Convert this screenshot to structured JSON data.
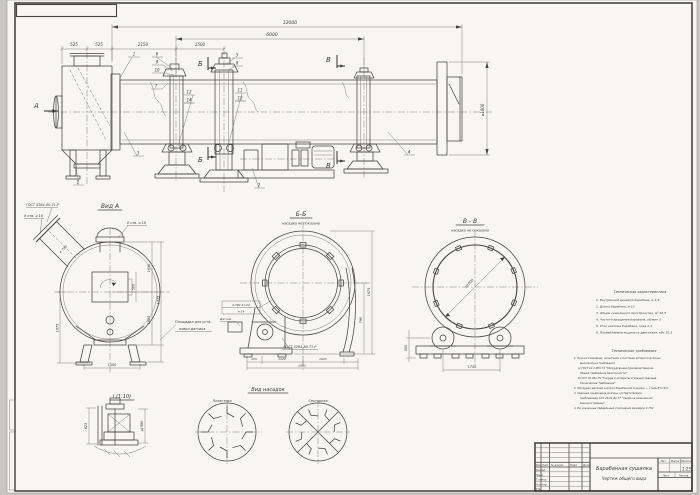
{
  "colors": {
    "paper": "#f7f6f1",
    "background": "#c7c6c1",
    "line": "#45443e",
    "thin_line": "#74736b",
    "text": "#3e3d37"
  },
  "main_view": {
    "view_arrow_label": "А",
    "section_b_label": "Б",
    "section_v_label": "В",
    "dims": {
      "overall": "12000",
      "between_supports": "6000",
      "left_a": "525",
      "left_b": "525",
      "left_c": "2150",
      "left_d": "1500",
      "drum_dia": "⌀1800"
    },
    "callouts": [
      "1",
      "2",
      "3",
      "4",
      "5",
      "6",
      "7",
      "8",
      "9",
      "10",
      "11",
      "12",
      "13",
      "14"
    ]
  },
  "view_a": {
    "title": "Вид А",
    "weld_note": "ГОСТ 5264-80-Т1-Р",
    "holes_left": "8 отв. ⌀ 18",
    "holes_top": "8 отв. ⌀ 18",
    "nozzle_dia": "⌀ 790",
    "hatch_dim": "500",
    "dim_right_top": "1630",
    "dim_right_bottom": "1605",
    "dim_right_overall": "1775",
    "dim_left": "1675",
    "dim_bottom": "1500",
    "platform_note_line1": "Площадка для уста-",
    "platform_note_line2": "новки датчика"
  },
  "section_bb": {
    "title": "Б-Б",
    "subtitle": "насадка не показана",
    "weld_flag_top": "2-Т82 Σ=22",
    "weld_flag_bottom": "п-14",
    "sensor_label": "Датчик",
    "weld_note": "ГОСТ 5264-80-Т1-Р",
    "dim_right_overall": "1675",
    "dim_right_inner": "790",
    "dim_bottom_a": "105",
    "dim_bottom_b": "1220",
    "dim_bottom_c": "1625",
    "dim_bottom_overall": "1683"
  },
  "section_vv": {
    "title": "В - В",
    "subtitle": "насадка не показана",
    "drum_dia": "⌀1800",
    "dim_bottom": "1750",
    "dim_left": "500"
  },
  "nozzle_views": {
    "title": "Вид насадок",
    "left_label": "Лопастная",
    "right_label": "Секторная"
  },
  "detail_i": {
    "title": "I (1:10)",
    "dim_right": "⌀1580",
    "dim_left": "625"
  },
  "tech_char": {
    "title": "Техническая характеристика",
    "items": [
      "1. Внутренний диаметр барабана, м 1,8",
      "2. Длина барабана, м 12",
      "3. Объем сушильного пространства, м³ 30,5",
      "4. Частота вращения барабана, об/мин 5",
      "5. Угол наклона барабана, град 2,4",
      "6. Потребляемая мощность двигателя, кВт 10,3"
    ]
  },
  "tech_req": {
    "title": "Технические требования",
    "lines": [
      "1. При изготовлении, испытании и поставке аппарата должны",
      "выполняться требования:",
      "а) ГОСТ 12.2.003-74 \"Оборудование производственное.",
      "Общие требования безопасности\";",
      "б) ОСТ 26.291-79 \"Сосуды и аппараты стальные сварные.",
      "Технические требования\".",
      "2. Материал деталей корпуса барабанной сушилки — сталь В Ст3сп.",
      "3. Сварные соединения должны соответствовать",
      "требованиям ОСТ 26-01-82-77 \"Сварка в химическом",
      "машиностроении\".",
      "4. Не указанные предельные отклонения размеров ± IT/2."
    ]
  },
  "title_block": {
    "doc_name": "Барабанная сушилка",
    "doc_type": "Чертеж общего вида",
    "scale_value": "1:25",
    "col_izm": "Изм.",
    "col_list": "Лист",
    "col_dokum": "№ докум.",
    "col_podp": "Подп.",
    "col_data": "Дата",
    "role_razrab": "Разраб.",
    "role_prov": "Пров.",
    "role_tkontr": "Т.контр.",
    "role_nkontr": "Н.контр.",
    "role_utv": "Утв.",
    "lit_label": "Лит.",
    "mass_label": "Масса",
    "scale_label": "Масштаб",
    "sheet_label": "Лист",
    "sheets_label": "Листов"
  }
}
